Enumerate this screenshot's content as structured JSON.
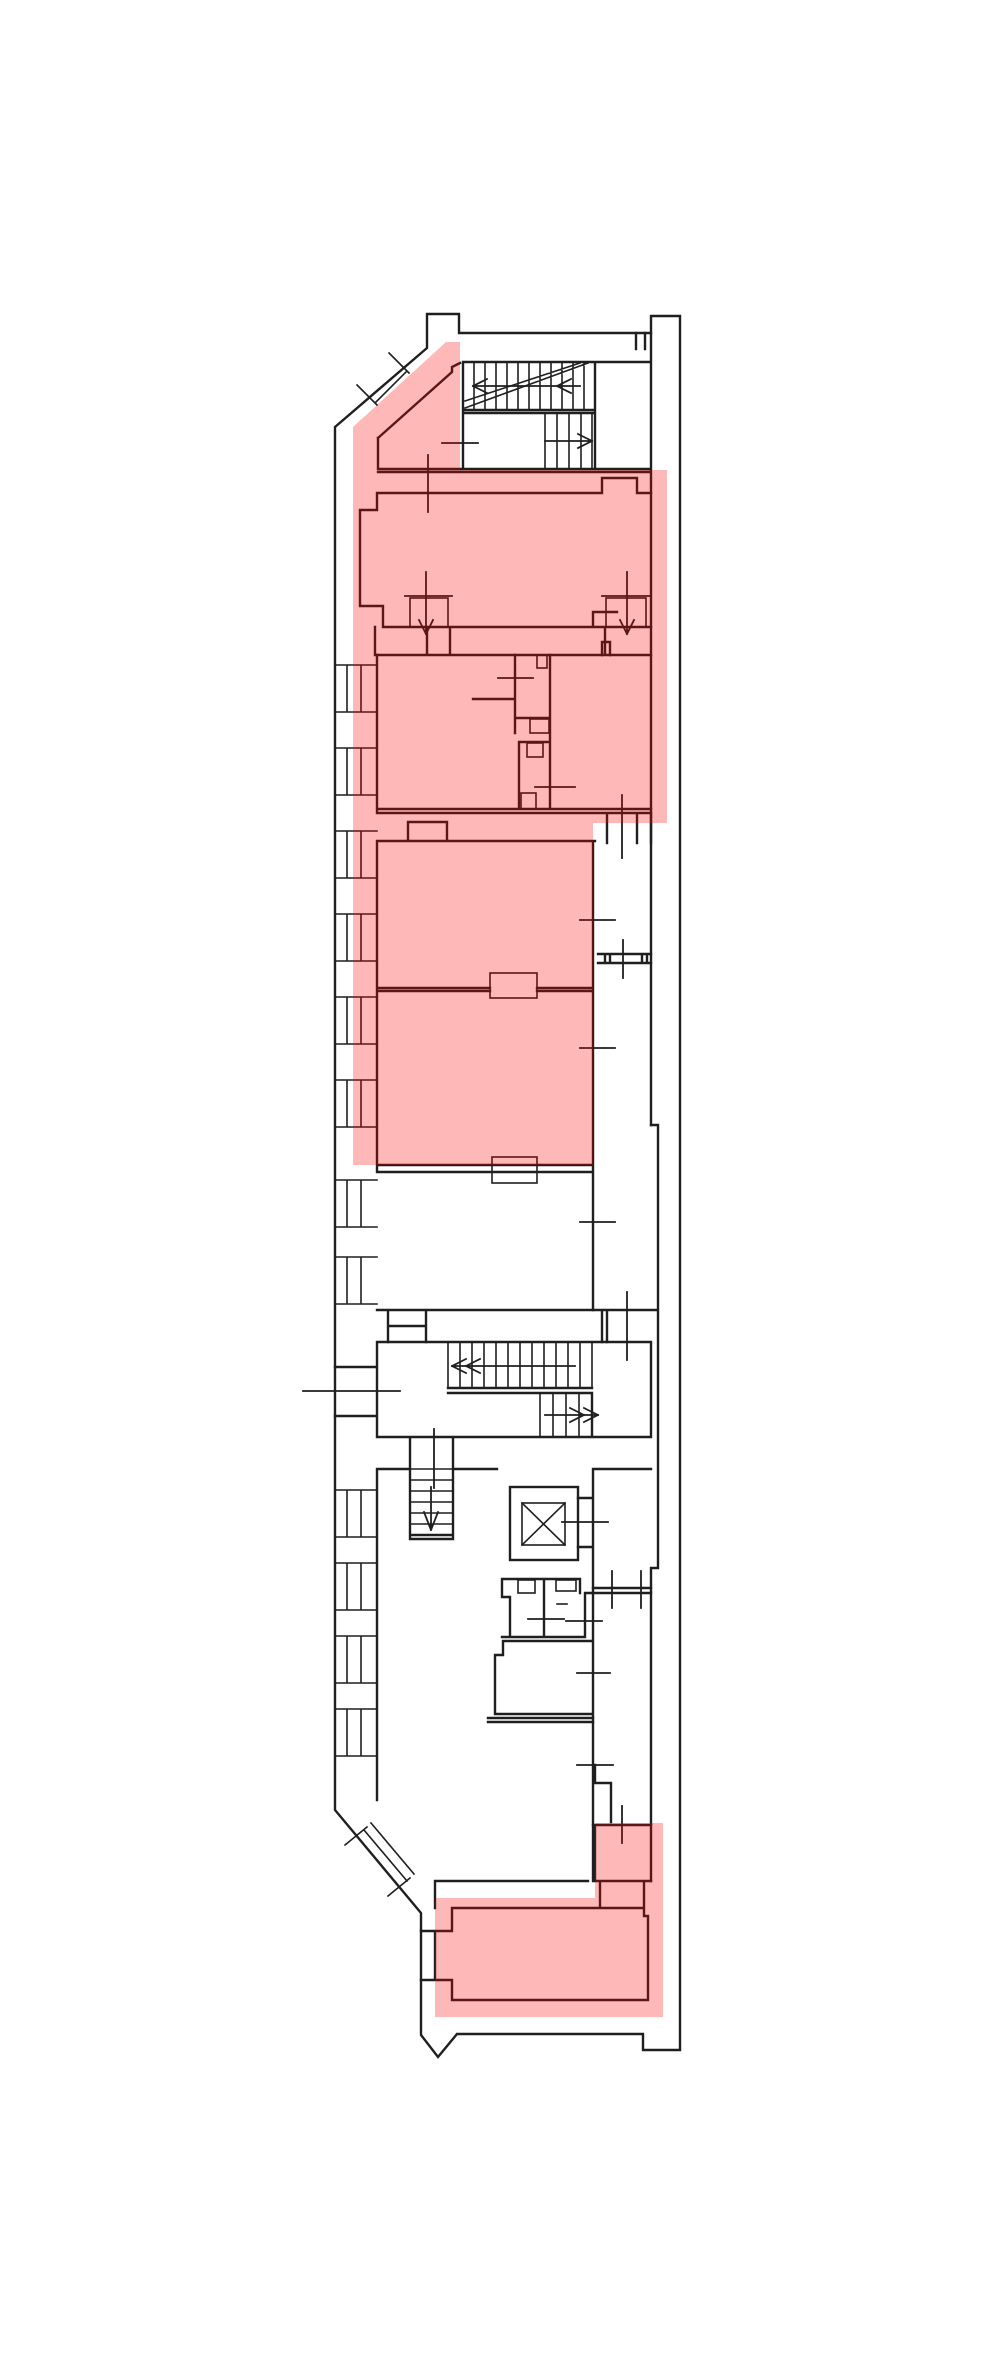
{
  "plan": {
    "background_color": "#ffffff",
    "wall_color": "#1f1f1f",
    "highlight_color": "rgba(255,0,0,0.28)",
    "highlighted_regions": [
      {
        "id": "upper-unit"
      },
      {
        "id": "lower-unit"
      }
    ],
    "features": {
      "stairwells": 3,
      "elevator": 1,
      "left_facade_window_bays": 10
    }
  }
}
